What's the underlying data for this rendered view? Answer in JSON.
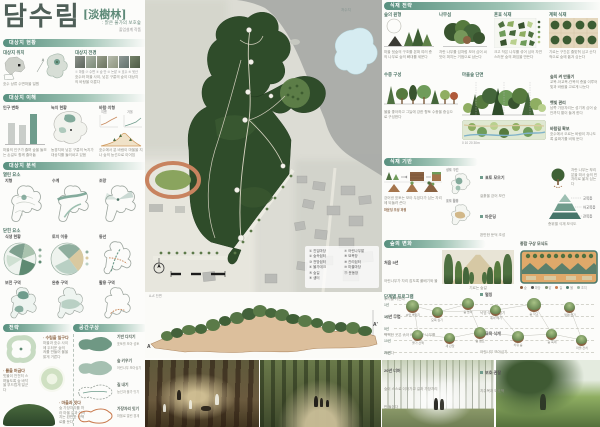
{
  "poster": {
    "title": "담수림",
    "title_hanja": "[淡樹林]",
    "subtitle": ": 맑은 물가의 보호숲",
    "byline": "졸업설계 작품"
  },
  "left": {
    "s1": {
      "header": "대상지 현황",
      "loc_label": "대상지 위치",
      "loc_caption": "호수 상류 수변마을 일원",
      "view_label": "대상지 전경",
      "photo_tags": "① 마을  ② 수변  ③ 숲 안  ④ 논밭  ⑤ 호수  ⑥ 뒷산",
      "view_caption": "호수와 마을 사이, 낮은 구릉의 숲이 대상지의 바탕을 이룬다"
    },
    "s2": {
      "header": "대상지 이해",
      "c1_title": "인구 변화",
      "c1_caption": "마을의 인구가 줄며 숲을 돌보는 손길도 함께 줄어듦",
      "c2_title": "녹지 현황",
      "c2_caption": "농경지와 낮은 구릉의 녹지가 대상지를 둘러싸고 있음",
      "c3_title": "바람·지형",
      "c3_a": "여름",
      "c3_b": "겨울",
      "c3_caption": "호수에서 분 바람이 마을을 지나 숲의 능선으로 이어짐",
      "c1_bars": [
        62,
        58,
        88
      ]
    },
    "s3": {
      "header": "대상지 분석",
      "open_label": "열린 요소",
      "closed_label": "닫힌 요소",
      "open": [
        {
          "title": "지형"
        },
        {
          "title": "수계"
        },
        {
          "title": "조망"
        }
      ],
      "closed": [
        {
          "title": "식생 현황"
        },
        {
          "title": "토지 이용"
        },
        {
          "title": "동선"
        }
      ],
      "zones": [
        {
          "title": "보전 구역"
        },
        {
          "title": "완충 구역"
        },
        {
          "title": "활용 구역"
        }
      ]
    },
    "s4": {
      "header_a": "전략",
      "header_b": "공간구상",
      "b1_title": "· 수림을 일구다",
      "b1_text": "마을과 호수 사이에 두터운 숲의 켜를 만들어 물을 맑게 거른다",
      "b2_title": "· 물을 머금다",
      "b2_text": "빗물이 천천히 스며들도록 숲 바닥을 부드럽게 일군다",
      "b3_title": "· 마을과 잇다",
      "b3_text": "숲 가장자리를 따라 마을 길과 이어지는 완만한 산책로를 둔다",
      "steps": [
        {
          "label": "기반 다지기",
          "note": "표토를 모아 성토"
        },
        {
          "label": "숲 키우기",
          "note": "어린나무 모아심기"
        },
        {
          "label": "길 내기",
          "note": "능선과 물가 잇기"
        },
        {
          "label": "가장자리 잇기",
          "note": "마을로 열린 경계"
        }
      ]
    }
  },
  "map": {
    "lake_label": "저수지",
    "legend": {
      "items": [
        "① 진입마당",
        "② 숲속쉼터",
        "③ 전망쉼터",
        "④ 물가데크",
        "⑤ 숲길",
        "⑥ 샘터",
        "⑦ 어린나무밭",
        "⑧ 묘목장",
        "⑨ 관리쉼터",
        "⑩ 마을마당",
        "⑪ 운동장"
      ]
    },
    "section_a": "A",
    "section_a2": "A'",
    "section_label": "A-A' 단면"
  },
  "right": {
    "h1": "식재 전략",
    "row1": [
      {
        "title": "숲의 원형",
        "caption": "마을 뒷숲의 구조를 본떠 여러 층의 나무로 숲의 뼈대를 세운다"
      },
      {
        "title": "나무섬",
        "caption": "자란 나무를 섬처럼 모아 심어 씨앗이 퍼지는 거점으로 삼는다"
      },
      {
        "title": "혼효 식재",
        "caption": "크고 작은 나무를 섞어 심어 자연스러운 숲의 짜임을 만든다"
      },
      {
        "title": "계획 식재",
        "caption": "기르는 구간은 줄맞춰 심고 순차적으로 숲에 옮겨 심는다"
      }
    ],
    "row2": {
      "trees_title": "수종 구성",
      "trees_caption": "물을 좋아하고 그늘에 강한 향토 수종을 중심으로 구성한다",
      "forest_title": "마을숲 단면",
      "forest_scale": "0        10        20        30m",
      "notes": [
        {
          "title": "숲의 켜 만들기",
          "text": "교목-아교목-관목의 층을 이루어 빛과 바람을 고르게 나눈다"
        },
        {
          "title": "햇빛 관리",
          "text": "남쪽 가장자리는 성기게 심어 숲 안까지 볕이 들게 한다"
        },
        {
          "title": "바람길 확보",
          "text": "호수에서 오르는 바람이 지나도록 골짜기를 비워 둔다"
        }
      ]
    },
    "h2": "식재 기반",
    "row3": {
      "soil_caption": "걷어낸 표토는 모아 두었다가 심는 자리에 되돌려 쓴다",
      "mound_caption": "마운딩 조성 과정",
      "maps": [
        {
          "title": "성토 구간"
        },
        {
          "title": "표토 활용"
        }
      ],
      "bullets": [
        {
          "title": "표토 모으기",
          "text": "겉흙을 걷어 보관"
        },
        {
          "title": "마운딩",
          "text": "완만한 둔덕 조성"
        },
        {
          "title": "배수 개선",
          "text": "물길 따라 골 내기"
        },
        {
          "title": "멀칭",
          "text": "낙엽·우드칩 덮기"
        },
        {
          "title": "묘목 식재",
          "text": "어린나무 모아심기"
        },
        {
          "title": "보호·관찰",
          "text": "지주목과 보호책"
        }
      ],
      "tree_note": "자란 나무는 뿌리분을 떠서 숲의 빈자리로 옮겨 심는다",
      "pyramid_labels": [
        "교목층",
        "아교목층",
        "관목층"
      ],
      "pyramid_caption": "층위별 식재 모식도"
    },
    "h3": "숲의 변화",
    "h3_right": "종합 구상 모식도",
    "row4": {
      "paras": [
        {
          "title": "처음 5년",
          "text": "어린나무가 자리 잡도록 풀베기와 물주기를 거든다"
        },
        {
          "title": "10년 무렵",
          "text": "빽빽한 곳은 솎아 베어 남은 나무를 키운다"
        },
        {
          "title": "20년 너머",
          "text": "숲이 스스로 이어가고 길과 가장자리만 돌본다"
        }
      ],
      "allee_caption": "기르는 숲길",
      "mosaic_title": "공간 짜임",
      "mosaic_legend": [
        {
          "label": "숲"
        },
        {
          "label": "마당"
        },
        {
          "label": "밭"
        },
        {
          "label": "길"
        },
        {
          "label": "물"
        },
        {
          "label": "초지"
        }
      ]
    },
    "program": {
      "title": "단계별 프로그램",
      "years": [
        "1년",
        "3년",
        "5년",
        "10년",
        "20년"
      ],
      "items": [
        "씨앗 뿌리기",
        "묘목 심기",
        "숲 놀이",
        "솎아 베기",
        "숲 학교",
        "열매 줍기",
        "물가 산책",
        "새 관찰",
        "숲 캠프",
        "치유 숲",
        "숲 축제",
        "마을 잔치"
      ]
    }
  }
}
